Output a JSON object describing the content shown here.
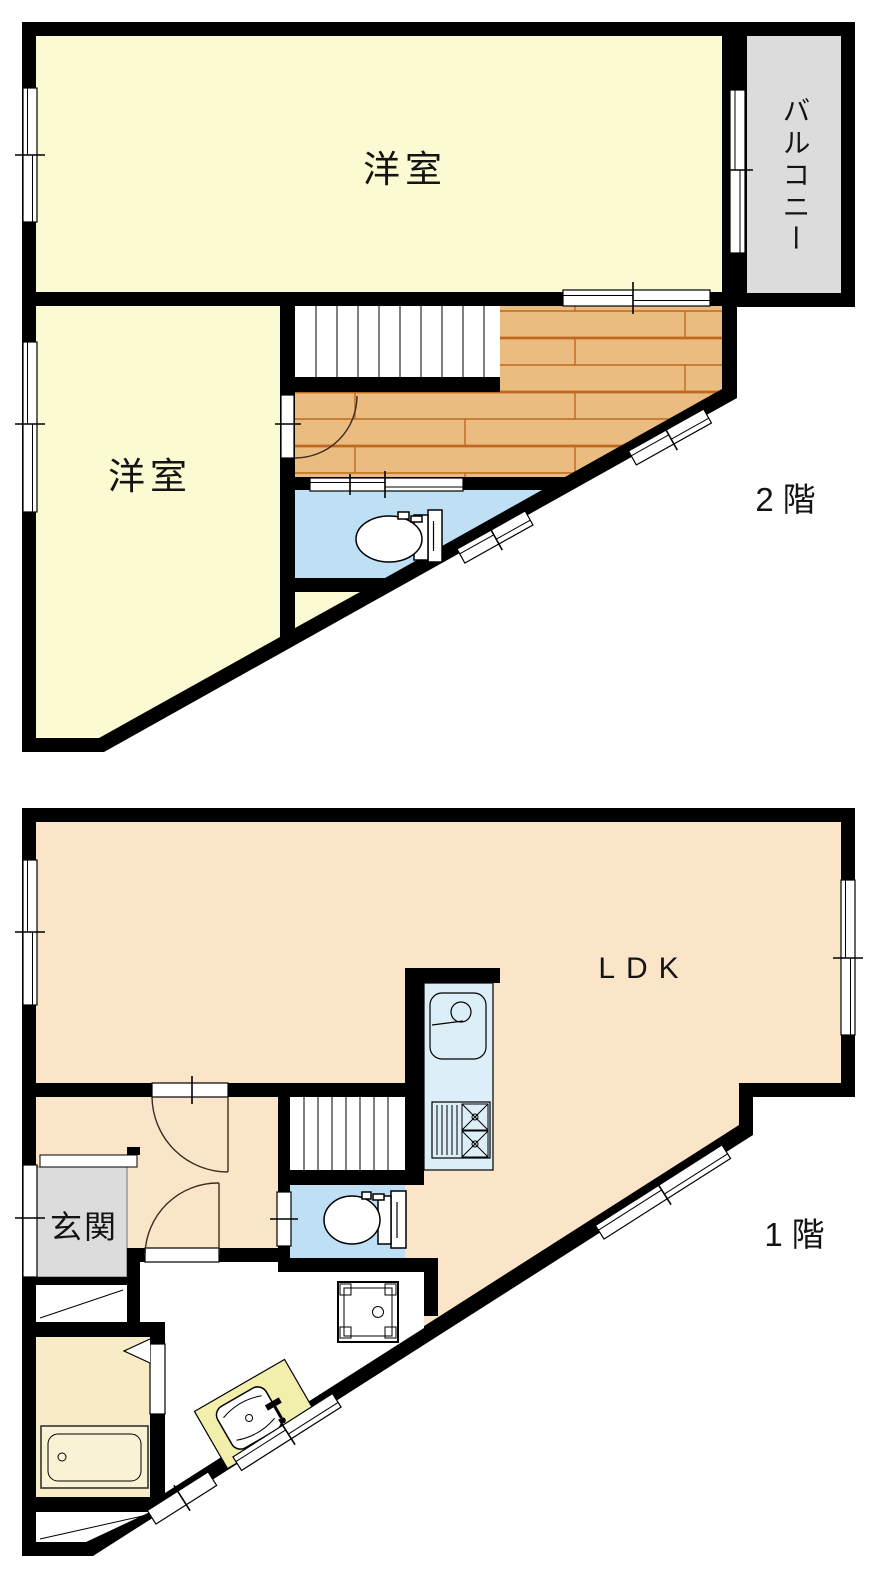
{
  "palette": {
    "wall": "#000000",
    "background": "#ffffff",
    "room_yellow": "#FCFAD2",
    "balcony_gray": "#DCDCDC",
    "wood_floor": "#EABC80",
    "wood_line": "#C0681F",
    "toilet_blue": "#BFE0F4",
    "ldk_peach": "#FAE5C9",
    "kitchen_blue": "#DCEEF8",
    "entrance_gray": "#DCDCDC",
    "bath_cream": "#F8ECC6",
    "tub_cream": "#FAF2D4",
    "vanity_yellow": "#F2EFAC",
    "text": "#141414"
  },
  "floor2": {
    "floor_label": "2階",
    "room_top_label": "洋室",
    "room_left_label": "洋室",
    "balcony_label": "バルコニー"
  },
  "floor1": {
    "floor_label": "1階",
    "ldk_label": "LDK",
    "entrance_label": "玄関"
  }
}
